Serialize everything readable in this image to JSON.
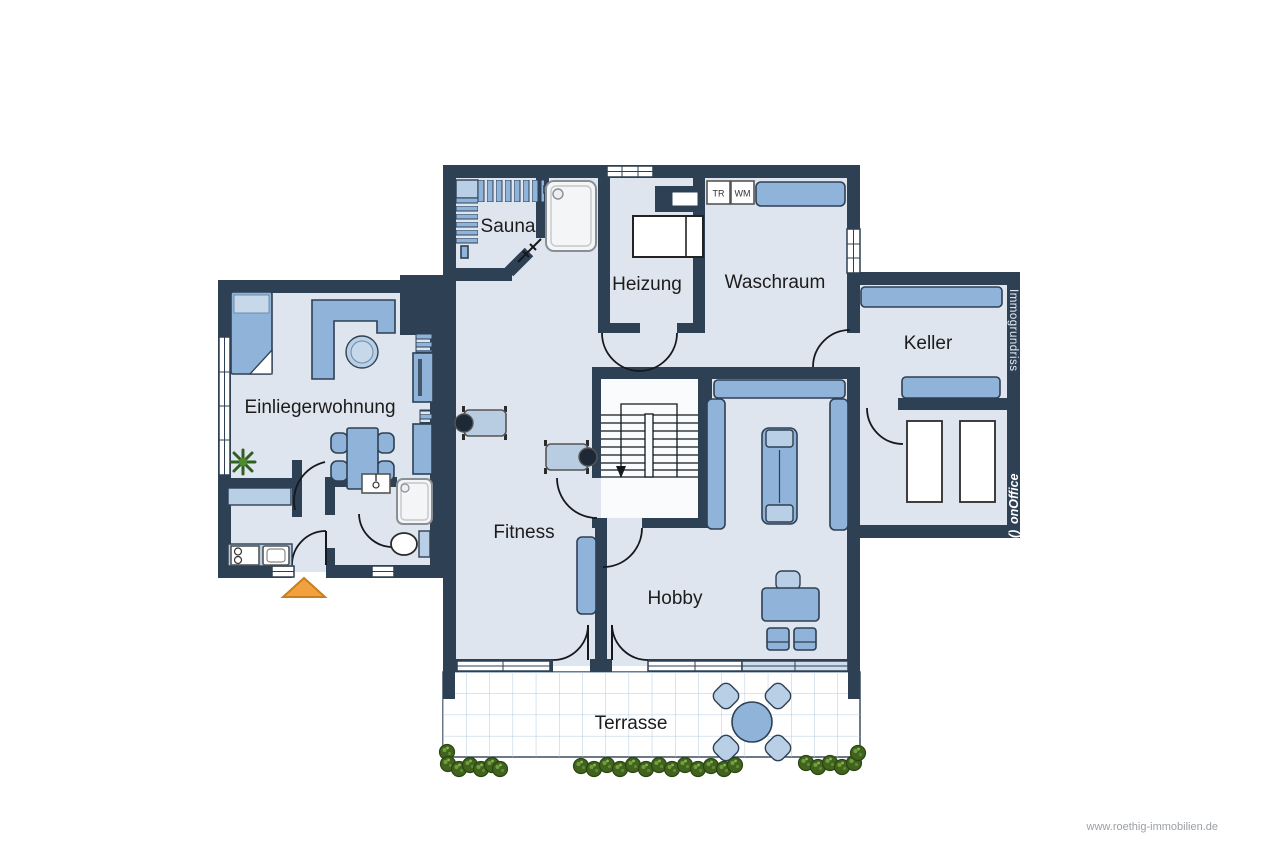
{
  "page": {
    "background": "#ffffff"
  },
  "colors": {
    "wall": "#2e4053",
    "floor": "#dfe5ee",
    "furniture": "#8fb3d9",
    "furniture_light": "#b9cfe6",
    "accent_orange": "#f2a13e",
    "hedge_green": "#41631e",
    "terrace_grid": "#b3c9dd",
    "watermark_text": "#e8eef5",
    "website_text": "#9aa0a6"
  },
  "rooms": {
    "sauna": "Sauna",
    "heizung": "Heizung",
    "waschraum": "Waschraum",
    "keller": "Keller",
    "einliegerwohnung": "Einliegerwohnung",
    "fitness": "Fitness",
    "hobby": "Hobby",
    "terrasse": "Terrasse"
  },
  "appliances": {
    "dryer": "TR",
    "washer": "WM"
  },
  "watermarks": {
    "brand": "Immogrundriss",
    "logo_mark": "()",
    "logo": "onOffice",
    "website": "www.roethig-immobilien.de"
  }
}
